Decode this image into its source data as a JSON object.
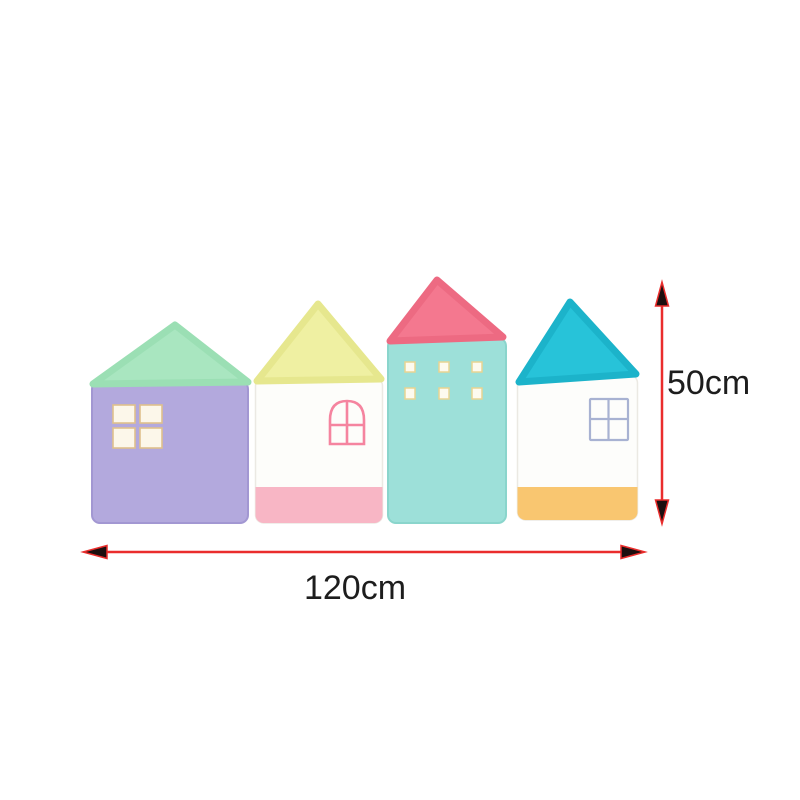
{
  "image": {
    "background": "#ffffff",
    "description": "Four pastel house-shaped crib bumper cushions in a row, annotated with red dimension arrows"
  },
  "dimensions": {
    "height_label": "50cm",
    "width_label": "120cm",
    "line_color": "#ea2d2c",
    "arrowhead_color": "#1d0f0f",
    "label_color": "#1d1d1d"
  },
  "houses": [
    {
      "name": "lavender house with mint roof",
      "roof_color": "#a9e6c0",
      "roof_edge": "#9bdfb4",
      "body_color": "#b3a9dd",
      "body_edge": "#a297d2",
      "window_pane_color": "#fcf7ea",
      "window_frame_color": "#dfc08c",
      "window_style": "2x2 solid panes"
    },
    {
      "name": "white house with yellow roof and pink base",
      "roof_color": "#eff0a2",
      "roof_edge": "#e6e78e",
      "body_color": "#fdfdfa",
      "body_edge": "#ebe9e3",
      "base_color": "#f8b6c5",
      "base_edge": "#f2a2b5",
      "window_frame_color": "#f5849f",
      "window_style": "arched outline"
    },
    {
      "name": "teal house with coral roof",
      "roof_color": "#f4788f",
      "roof_edge": "#ed6a82",
      "body_color": "#9de0d9",
      "body_edge": "#8ad5cc",
      "window_pane_color": "#fdfaef",
      "window_frame_color": "#e8d492",
      "window_style": "six small squares"
    },
    {
      "name": "white house with cyan roof and yellow base",
      "roof_color": "#27c3d9",
      "roof_edge": "#1cb3ca",
      "body_color": "#fdfdfb",
      "body_edge": "#ebe9e3",
      "base_color": "#f9c670",
      "base_edge": "#efb85b",
      "window_frame_color": "#a8b2d2",
      "window_style": "2x2 outline"
    }
  ]
}
